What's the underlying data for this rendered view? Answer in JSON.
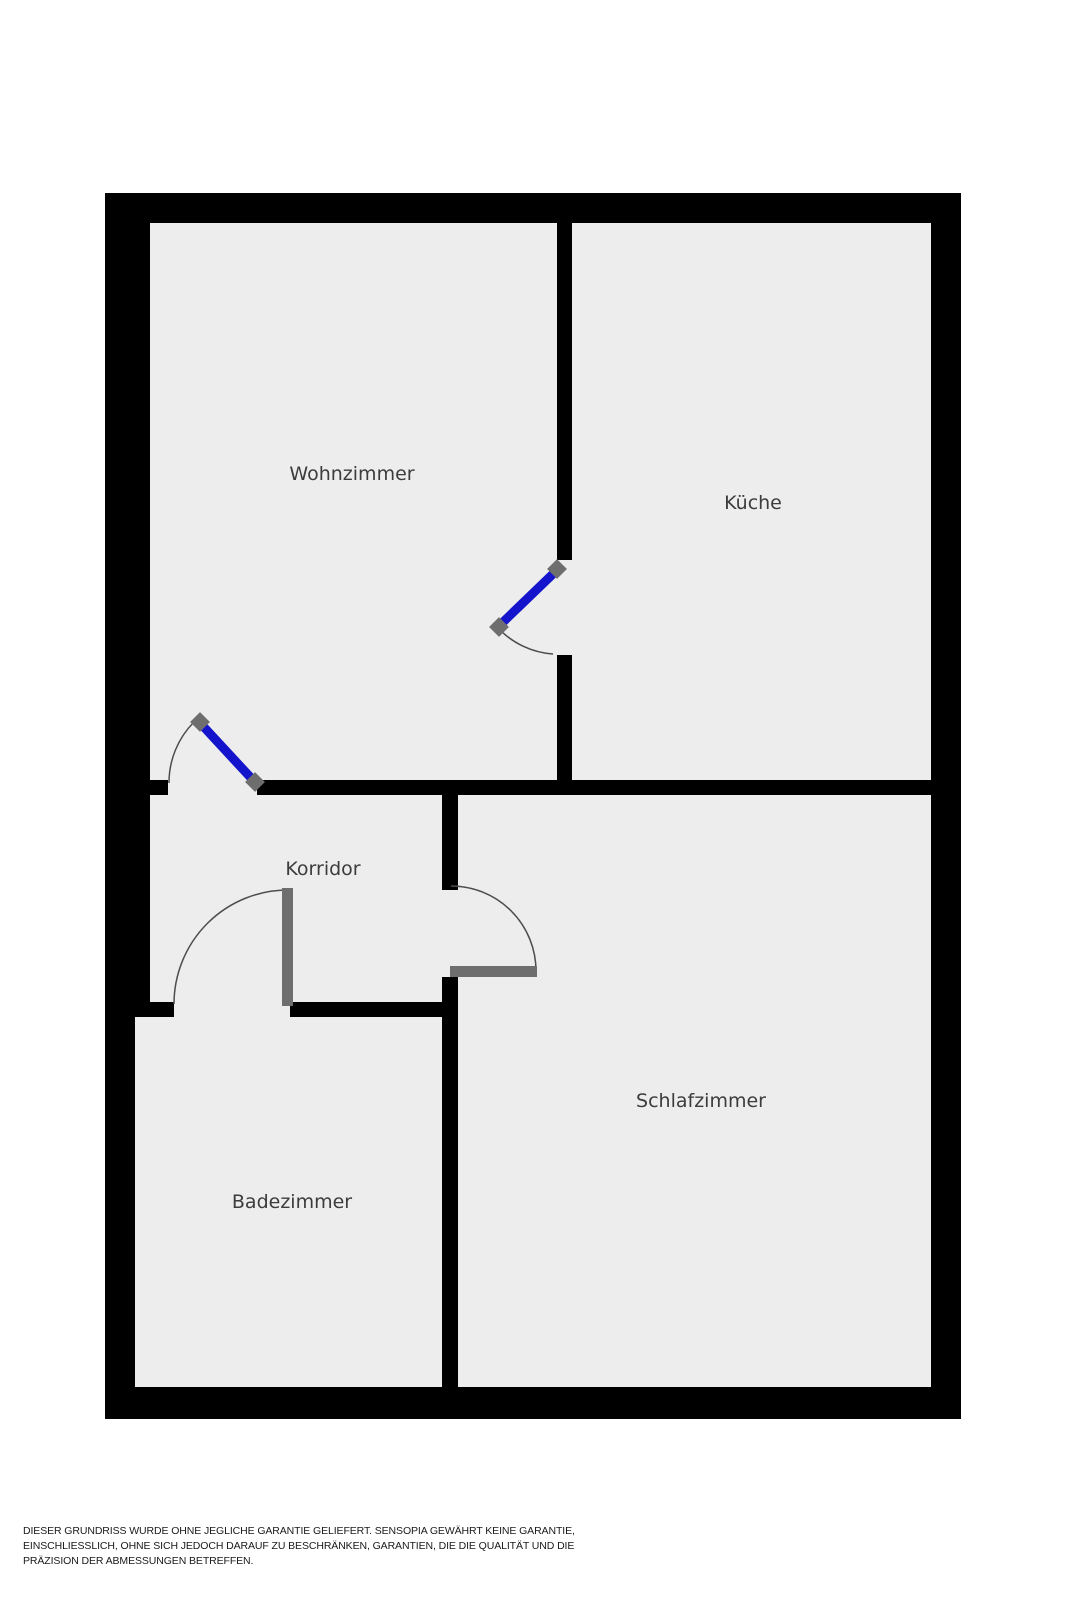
{
  "title": "Grundriss (floor plan)",
  "rooms": {
    "wohnzimmer": "Wohnzimmer",
    "kueche": "Küche",
    "korridor": "Korridor",
    "badezimmer": "Badezimmer",
    "schlafzimmer": "Schlafzimmer"
  },
  "disclaimer": {
    "lines": [
      "DIESER GRUNDRISS WURDE OHNE JEGLICHE GARANTIE GELIEFERT. SENSOPIA GEWÄHRT KEINE GARANTIE,",
      "EINSCHLIESSLICH, OHNE SICH JEDOCH DARAUF ZU BESCHRÄNKEN, GARANTIEN, DIE DIE QUALITÄT UND DIE",
      "PRÄZISION DER ABMESSUNGEN BETREFFEN."
    ]
  },
  "colors": {
    "wall": "#000000",
    "floor": "#ededed",
    "door-blue": "#1414cc",
    "door-gray": "#6e6e6e",
    "arc": "#4d4d4d",
    "label": "#3c3c3c",
    "disclaimer": "#1a1a1a",
    "bg": "#ffffff"
  }
}
